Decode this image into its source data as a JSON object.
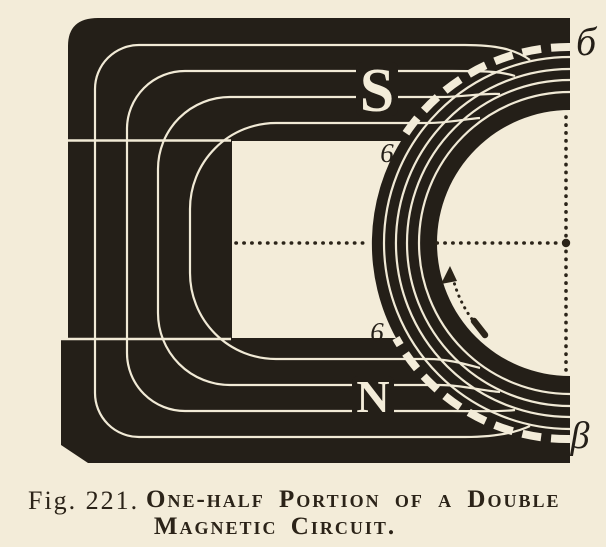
{
  "figure": {
    "pole_labels": {
      "top": "S",
      "bottom": "N"
    },
    "boundary_labels": {
      "top_right": "б",
      "top_inner": "6",
      "bottom_inner": "6",
      "bottom_right": "β"
    },
    "caption": {
      "fig_label": "Fig. 221.",
      "title_line1": "One-half Portion of a Double",
      "title_line2": "Magnetic Circuit."
    },
    "colors": {
      "paper": "#f3ecd9",
      "ink": "#241f18",
      "line": "#f1ead6"
    }
  }
}
